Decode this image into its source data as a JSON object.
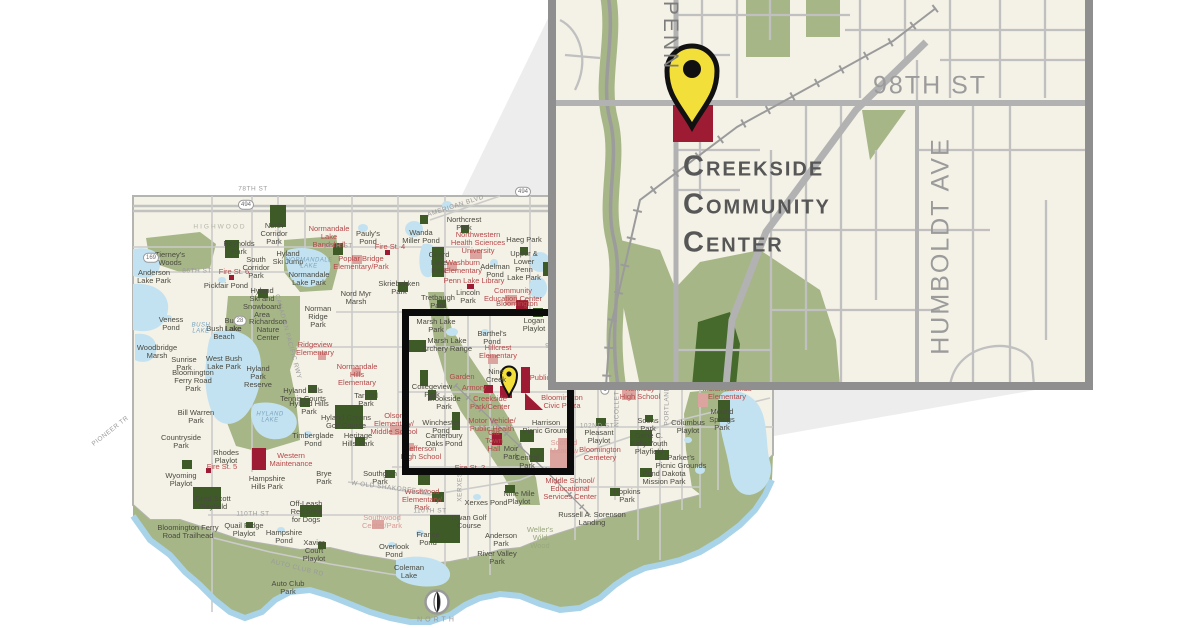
{
  "title": "Creekside Community Center locator map",
  "colors": {
    "map_cream": "#f4f1e6",
    "floodplain_green": "#a6b687",
    "park_dark_green": "#3e5b27",
    "water_blue": "#c3e2f1",
    "civic_maroon": "#9e1c33",
    "school_pink": "#dba49e",
    "pin_yellow": "#f3df3a",
    "frame_gray": "#8f8f8f",
    "ray_gray": "#ededed",
    "road_gray": "#c8c8c6"
  },
  "inset": {
    "labels": [
      {
        "t": "PENN",
        "x": 670,
        "y": 36,
        "c": "inset-street-sm",
        "r": 90
      },
      {
        "t": "98TH ST",
        "x": 930,
        "y": 86,
        "c": "inset-street"
      },
      {
        "t": "HUMBOLDT  AVE",
        "x": 941,
        "y": 246,
        "c": "inset-street",
        "r": -90
      },
      {
        "t": "Creekside",
        "x": 683,
        "y": 167,
        "c": "ccc"
      },
      {
        "t": "Community",
        "x": 683,
        "y": 205,
        "c": "ccc"
      },
      {
        "t": "Center",
        "x": 683,
        "y": 243,
        "c": "ccc"
      }
    ]
  },
  "compass": {
    "label": "NORTH"
  },
  "main_map": {
    "labels": [
      {
        "t": "Tierney's\nWoods",
        "x": 170,
        "y": 259,
        "c": "park"
      },
      {
        "t": "Anderson\nLake Park",
        "x": 154,
        "y": 277,
        "c": "park"
      },
      {
        "t": "Reynolds\nPark",
        "x": 239,
        "y": 248,
        "c": "park"
      },
      {
        "t": "North\nCorridor\nPark",
        "x": 274,
        "y": 234,
        "c": "park"
      },
      {
        "t": "South\nCorridor\nPark",
        "x": 256,
        "y": 268,
        "c": "park"
      },
      {
        "t": "Hyland\nSki Jump",
        "x": 288,
        "y": 258,
        "c": "park"
      },
      {
        "t": "Normandale\nLake Park",
        "x": 309,
        "y": 279,
        "c": "park"
      },
      {
        "t": "Hyland\nSki and\nSnowboard\nArea",
        "x": 262,
        "y": 303,
        "c": "park"
      },
      {
        "t": "Norman\nRidge\nPark",
        "x": 318,
        "y": 317,
        "c": "park"
      },
      {
        "t": "Richardson\nNature\nCenter",
        "x": 268,
        "y": 330,
        "c": "park"
      },
      {
        "t": "Pickfair Pond",
        "x": 226,
        "y": 286,
        "c": "park"
      },
      {
        "t": "Veness\nPond",
        "x": 171,
        "y": 324,
        "c": "park"
      },
      {
        "t": "Bush\nLake",
        "x": 233,
        "y": 325,
        "c": "park"
      },
      {
        "t": "Bush Lake\nBeach",
        "x": 224,
        "y": 333,
        "c": "park"
      },
      {
        "t": "Pauly's\nPond",
        "x": 368,
        "y": 238,
        "c": "park"
      },
      {
        "t": "Wanda\nMiller Pond",
        "x": 421,
        "y": 237,
        "c": "park"
      },
      {
        "t": "Girard\nLake\nPark",
        "x": 439,
        "y": 263,
        "c": "park"
      },
      {
        "t": "Skriebakken\nPark",
        "x": 399,
        "y": 288,
        "c": "park"
      },
      {
        "t": "Nord Myr\nMarsh",
        "x": 356,
        "y": 298,
        "c": "park"
      },
      {
        "t": "Tretbaugh\nPark",
        "x": 438,
        "y": 302,
        "c": "park"
      },
      {
        "t": "Haeg Park",
        "x": 524,
        "y": 240,
        "c": "park"
      },
      {
        "t": "Northcrest\nPark",
        "x": 464,
        "y": 224,
        "c": "park"
      },
      {
        "t": "Upper &\nLower\nPenn\nLake Park",
        "x": 524,
        "y": 266,
        "c": "park"
      },
      {
        "t": "Adelman\nPond",
        "x": 495,
        "y": 271,
        "c": "park"
      },
      {
        "t": "Lincoln\nPark",
        "x": 468,
        "y": 297,
        "c": "park"
      },
      {
        "t": "Logan\nPlaylot",
        "x": 534,
        "y": 325,
        "c": "park"
      },
      {
        "t": "Marsh Lake\nPark",
        "x": 436,
        "y": 326,
        "c": "park"
      },
      {
        "t": "Barthel's\nPond",
        "x": 492,
        "y": 338,
        "c": "park"
      },
      {
        "t": "Marsh Lake\nArchery Range",
        "x": 447,
        "y": 345,
        "c": "park"
      },
      {
        "t": "Bill Warren\nPark",
        "x": 196,
        "y": 417,
        "c": "park"
      },
      {
        "t": "Woodbridge\nMarsh",
        "x": 157,
        "y": 352,
        "c": "park"
      },
      {
        "t": "Sunrise\nPark",
        "x": 184,
        "y": 364,
        "c": "park"
      },
      {
        "t": "West Bush\nLake Park",
        "x": 224,
        "y": 363,
        "c": "park"
      },
      {
        "t": "Bloomington\nFerry Road\nPark",
        "x": 193,
        "y": 381,
        "c": "park"
      },
      {
        "t": "Hyland\nPark\nReserve",
        "x": 258,
        "y": 377,
        "c": "park"
      },
      {
        "t": "Hyland Hills\nTennis Courts",
        "x": 303,
        "y": 395,
        "c": "park"
      },
      {
        "t": "Hyland Hills\nPark",
        "x": 309,
        "y": 408,
        "c": "park"
      },
      {
        "t": "Tarnhill\nPark",
        "x": 366,
        "y": 400,
        "c": "park"
      },
      {
        "t": "Hyland Greens\nGolf Course",
        "x": 346,
        "y": 422,
        "c": "park"
      },
      {
        "t": "Countryside\nPark",
        "x": 181,
        "y": 442,
        "c": "park"
      },
      {
        "t": "Timberglade\nPond",
        "x": 313,
        "y": 440,
        "c": "park"
      },
      {
        "t": "Heritage\nHills Park",
        "x": 358,
        "y": 440,
        "c": "park"
      },
      {
        "t": "Rhodes\nPlaylot",
        "x": 226,
        "y": 457,
        "c": "park"
      },
      {
        "t": "Wyoming\nPlaylot",
        "x": 181,
        "y": 480,
        "c": "park"
      },
      {
        "t": "Dred Scott\nPlayfield",
        "x": 213,
        "y": 503,
        "c": "park"
      },
      {
        "t": "Bloomington Ferry\nRoad Trailhead",
        "x": 188,
        "y": 532,
        "c": "park"
      },
      {
        "t": "Quail Ridge\nPlaylot",
        "x": 244,
        "y": 530,
        "c": "park"
      },
      {
        "t": "Hampshire\nHills Park",
        "x": 267,
        "y": 483,
        "c": "park"
      },
      {
        "t": "Off-Leash\nRec Area\nfor Dogs",
        "x": 306,
        "y": 512,
        "c": "park"
      },
      {
        "t": "Hampshire\nPond",
        "x": 284,
        "y": 537,
        "c": "park"
      },
      {
        "t": "Xavier\nCourt\nPlaylot",
        "x": 314,
        "y": 551,
        "c": "park"
      },
      {
        "t": "Auto Club\nPark",
        "x": 288,
        "y": 588,
        "c": "park"
      },
      {
        "t": "Brye\nPark",
        "x": 324,
        "y": 478,
        "c": "park"
      },
      {
        "t": "Southglen\nPark",
        "x": 380,
        "y": 478,
        "c": "park"
      },
      {
        "t": "Overlook\nPond",
        "x": 394,
        "y": 551,
        "c": "park"
      },
      {
        "t": "France\nPond",
        "x": 428,
        "y": 539,
        "c": "park"
      },
      {
        "t": "Coleman\nLake",
        "x": 409,
        "y": 572,
        "c": "park"
      },
      {
        "t": "Xerxes Pond",
        "x": 486,
        "y": 503,
        "c": "park"
      },
      {
        "t": "Nine Mile\nPlaylot",
        "x": 519,
        "y": 498,
        "c": "park"
      },
      {
        "t": "Dwan Golf\nCourse",
        "x": 469,
        "y": 522,
        "c": "park"
      },
      {
        "t": "Anderson\nPark",
        "x": 501,
        "y": 540,
        "c": "park"
      },
      {
        "t": "River Valley\nPark",
        "x": 497,
        "y": 558,
        "c": "park"
      },
      {
        "t": "Russell A. Sorenson\nLanding",
        "x": 592,
        "y": 519,
        "c": "park"
      },
      {
        "t": "Soens\nPark",
        "x": 648,
        "y": 425,
        "c": "park"
      },
      {
        "t": "Columbus\nPlaylot",
        "x": 688,
        "y": 427,
        "c": "park"
      },
      {
        "t": "Gene C.\nKelly Youth\nPlayfield",
        "x": 649,
        "y": 444,
        "c": "park"
      },
      {
        "t": "Parker's\nPicnic Grounds",
        "x": 681,
        "y": 462,
        "c": "park"
      },
      {
        "t": "Pond Dakota\nMission Park",
        "x": 664,
        "y": 478,
        "c": "park"
      },
      {
        "t": "Hopkins\nPark",
        "x": 627,
        "y": 496,
        "c": "park"
      },
      {
        "t": "Mound\nSprings\nPark",
        "x": 722,
        "y": 420,
        "c": "park"
      },
      {
        "t": "Pleasant\nPlaylot",
        "x": 599,
        "y": 437,
        "c": "park"
      },
      {
        "t": "Harrison\nPicnic Ground",
        "x": 546,
        "y": 427,
        "c": "park"
      },
      {
        "t": "Brookside\nPark",
        "x": 444,
        "y": 403,
        "c": "park"
      },
      {
        "t": "Winchester\nPond",
        "x": 441,
        "y": 427,
        "c": "park"
      },
      {
        "t": "Canterbury\nOaks Pond",
        "x": 444,
        "y": 440,
        "c": "park"
      },
      {
        "t": "Moir\nPark",
        "x": 511,
        "y": 453,
        "c": "park"
      },
      {
        "t": "Central\nPark",
        "x": 527,
        "y": 462,
        "c": "park"
      },
      {
        "t": "Collegeview\nPark",
        "x": 432,
        "y": 391,
        "c": "park"
      },
      {
        "t": "Nine\nCreek",
        "x": 496,
        "y": 376,
        "c": "park"
      },
      {
        "t": "Weller's\nWild\nWood",
        "x": 540,
        "y": 538,
        "c": "olive"
      },
      {
        "t": "Normandale\nLake\nBandshell",
        "x": 329,
        "y": 237,
        "c": "red"
      },
      {
        "t": "Fire St. 4",
        "x": 390,
        "y": 247,
        "c": "red"
      },
      {
        "t": "Poplar Bridge\nElementary/Park",
        "x": 361,
        "y": 263,
        "c": "red"
      },
      {
        "t": "Fire St. 6",
        "x": 234,
        "y": 272,
        "c": "red"
      },
      {
        "t": "Northwestern\nHealth Sciences\nUniversity",
        "x": 478,
        "y": 243,
        "c": "red"
      },
      {
        "t": "Washburn\nElementary",
        "x": 463,
        "y": 267,
        "c": "red"
      },
      {
        "t": "Penn Lake Library",
        "x": 474,
        "y": 281,
        "c": "red"
      },
      {
        "t": "Community\nEducation Center",
        "x": 513,
        "y": 295,
        "c": "red"
      },
      {
        "t": "Bloomington\nIce Garden",
        "x": 517,
        "y": 308,
        "c": "red"
      },
      {
        "t": "Hillcrest\nElementary",
        "x": 498,
        "y": 352,
        "c": "red"
      },
      {
        "t": "Ridgeview\nElementary",
        "x": 315,
        "y": 349,
        "c": "red"
      },
      {
        "t": "Normandale\nHills\nElementary",
        "x": 357,
        "y": 375,
        "c": "red"
      },
      {
        "t": "Olson\nElementary/\nMiddle School",
        "x": 394,
        "y": 424,
        "c": "red"
      },
      {
        "t": "Western\nMaintenance",
        "x": 291,
        "y": 460,
        "c": "red"
      },
      {
        "t": "Fire St. 5",
        "x": 222,
        "y": 467,
        "c": "red"
      },
      {
        "t": "Westwood\nElementary/\nPark",
        "x": 422,
        "y": 500,
        "c": "red"
      },
      {
        "t": "Jefferson\nHigh School",
        "x": 421,
        "y": 453,
        "c": "red"
      },
      {
        "t": "Garden",
        "x": 462,
        "y": 377,
        "c": "red"
      },
      {
        "t": "Armory",
        "x": 474,
        "y": 388,
        "c": "red"
      },
      {
        "t": "Public",
        "x": 540,
        "y": 378,
        "c": "red"
      },
      {
        "t": "Creekside\nPark/Center",
        "x": 490,
        "y": 403,
        "c": "red"
      },
      {
        "t": "Motor Vehicle/\nPublic Health",
        "x": 492,
        "y": 425,
        "c": "red"
      },
      {
        "t": "Old\nTown\nHall",
        "x": 494,
        "y": 441,
        "c": "red"
      },
      {
        "t": "Fire St. 2",
        "x": 470,
        "y": 468,
        "c": "red"
      },
      {
        "t": "Bloomington\nCivic Plaza",
        "x": 562,
        "y": 402,
        "c": "red"
      },
      {
        "t": "Bloomington\nCemetery",
        "x": 600,
        "y": 454,
        "c": "red"
      },
      {
        "t": "Kennedy\nHigh School",
        "x": 640,
        "y": 393,
        "c": "red"
      },
      {
        "t": "Indian Mounds\nElementary",
        "x": 727,
        "y": 393,
        "c": "red"
      },
      {
        "t": "Middle School/\nEducational\nServices Center",
        "x": 570,
        "y": 489,
        "c": "red"
      },
      {
        "t": "Southwood\nCenter/Park",
        "x": 382,
        "y": 522,
        "c": "pink"
      },
      {
        "t": "Scofield\nMeadow",
        "x": 564,
        "y": 447,
        "c": "pink"
      },
      {
        "t": "NORMANDALE\nLAKE",
        "x": 309,
        "y": 264,
        "c": "water"
      },
      {
        "t": "HYLAND\nLAKE",
        "x": 270,
        "y": 418,
        "c": "water"
      },
      {
        "t": "BUSH\nLAKE",
        "x": 201,
        "y": 329,
        "c": "water"
      },
      {
        "t": "78TH ST",
        "x": 253,
        "y": 190,
        "c": "street"
      },
      {
        "t": "84TH ST",
        "x": 338,
        "y": 247,
        "c": "street"
      },
      {
        "t": "86TH ST",
        "x": 197,
        "y": 272,
        "c": "street"
      },
      {
        "t": "94TH ST",
        "x": 560,
        "y": 347,
        "c": "street"
      },
      {
        "t": "102ND ST",
        "x": 597,
        "y": 427,
        "c": "street"
      },
      {
        "t": "110TH ST",
        "x": 253,
        "y": 515,
        "c": "street"
      },
      {
        "t": "110TH ST",
        "x": 430,
        "y": 512,
        "c": "street"
      },
      {
        "t": "AMERICAN BLVD",
        "x": 456,
        "y": 207,
        "c": "street",
        "r": -18
      },
      {
        "t": "W OLD SHAKOPEE RD",
        "x": 390,
        "y": 489,
        "c": "street",
        "r": 7
      },
      {
        "t": "AUTO CLUB RD",
        "x": 297,
        "y": 569,
        "c": "street",
        "r": 14
      },
      {
        "t": "PIONEER TR",
        "x": 111,
        "y": 432,
        "c": "street",
        "r": -38
      },
      {
        "t": "XERXES",
        "x": 461,
        "y": 487,
        "c": "street",
        "r": -90
      },
      {
        "t": "PORTLAND",
        "x": 668,
        "y": 406,
        "c": "street",
        "r": -90
      },
      {
        "t": "NICOLLET AVE",
        "x": 618,
        "y": 401,
        "c": "street",
        "r": -90
      },
      {
        "t": "CANADIAN PACIFIC RWY",
        "x": 287,
        "y": 337,
        "c": "street",
        "r": 75
      },
      {
        "t": "HIGHWOOD",
        "x": 220,
        "y": 228,
        "c": "area"
      },
      {
        "t": "494",
        "x": 246,
        "y": 205,
        "c": "shield"
      },
      {
        "t": "494",
        "x": 523,
        "y": 192,
        "c": "shield"
      },
      {
        "t": "169",
        "x": 151,
        "y": 258,
        "c": "shield"
      },
      {
        "t": "28",
        "x": 240,
        "y": 321,
        "c": "shield"
      },
      {
        "t": "1",
        "x": 605,
        "y": 390,
        "c": "shield"
      }
    ]
  }
}
